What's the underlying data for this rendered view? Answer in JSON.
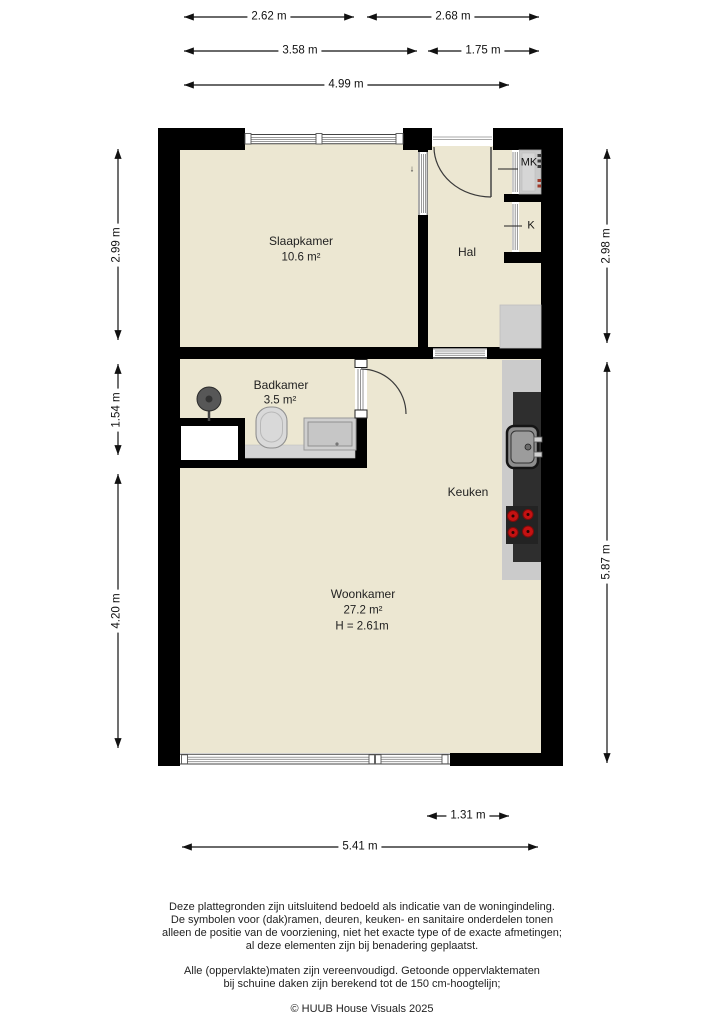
{
  "rooms": {
    "slaapkamer": {
      "name": "Slaapkamer",
      "area": "10.6 m²"
    },
    "hal": {
      "name": "Hal"
    },
    "badkamer": {
      "name": "Badkamer",
      "area": "3.5 m²"
    },
    "keuken": {
      "name": "Keuken"
    },
    "woonkamer": {
      "name": "Woonkamer",
      "area": "27.2 m²",
      "ceiling_height": "H = 2.61m"
    },
    "meterkast": {
      "label": "MK"
    },
    "kast": {
      "label": "K"
    }
  },
  "door_slide_marker": "↓",
  "dimensions": {
    "top_row1": [
      "2.62 m",
      "2.68 m"
    ],
    "top_row2": [
      "3.58 m",
      "1.75 m"
    ],
    "top_row3": [
      "4.99 m"
    ],
    "left": [
      "2.99 m",
      "1.54 m",
      "4.20 m"
    ],
    "right": [
      "2.98 m",
      "5.87 m"
    ],
    "bottom": [
      "1.31 m",
      "5.41 m"
    ]
  },
  "disclaimer": {
    "para1_line1": "Deze plattegronden zijn uitsluitend bedoeld als indicatie van de woningindeling.",
    "para1_line2": "De symbolen voor (dak)ramen, deuren, keuken- en sanitaire onderdelen tonen",
    "para1_line3": "alleen de positie van de voorziening, niet het exacte type of de exacte afmetingen;",
    "para1_line4": "al deze elementen zijn bij benadering geplaatst.",
    "para2_line1": "Alle (oppervlakte)maten zijn vereenvoudigd. Getoonde oppervlaktematen",
    "para2_line2": "bij schuine daken zijn berekend tot de 150 cm-hoogtelijn;",
    "copyright": "© HUUB House Visuals 2025"
  },
  "colors": {
    "floor": "#ece7d2",
    "wall": "#000000",
    "counter_light": "#cbcbcb",
    "counter_dark": "#2e2e2e",
    "appliance": "#cfcfcf",
    "burner_red": "#c51212"
  }
}
